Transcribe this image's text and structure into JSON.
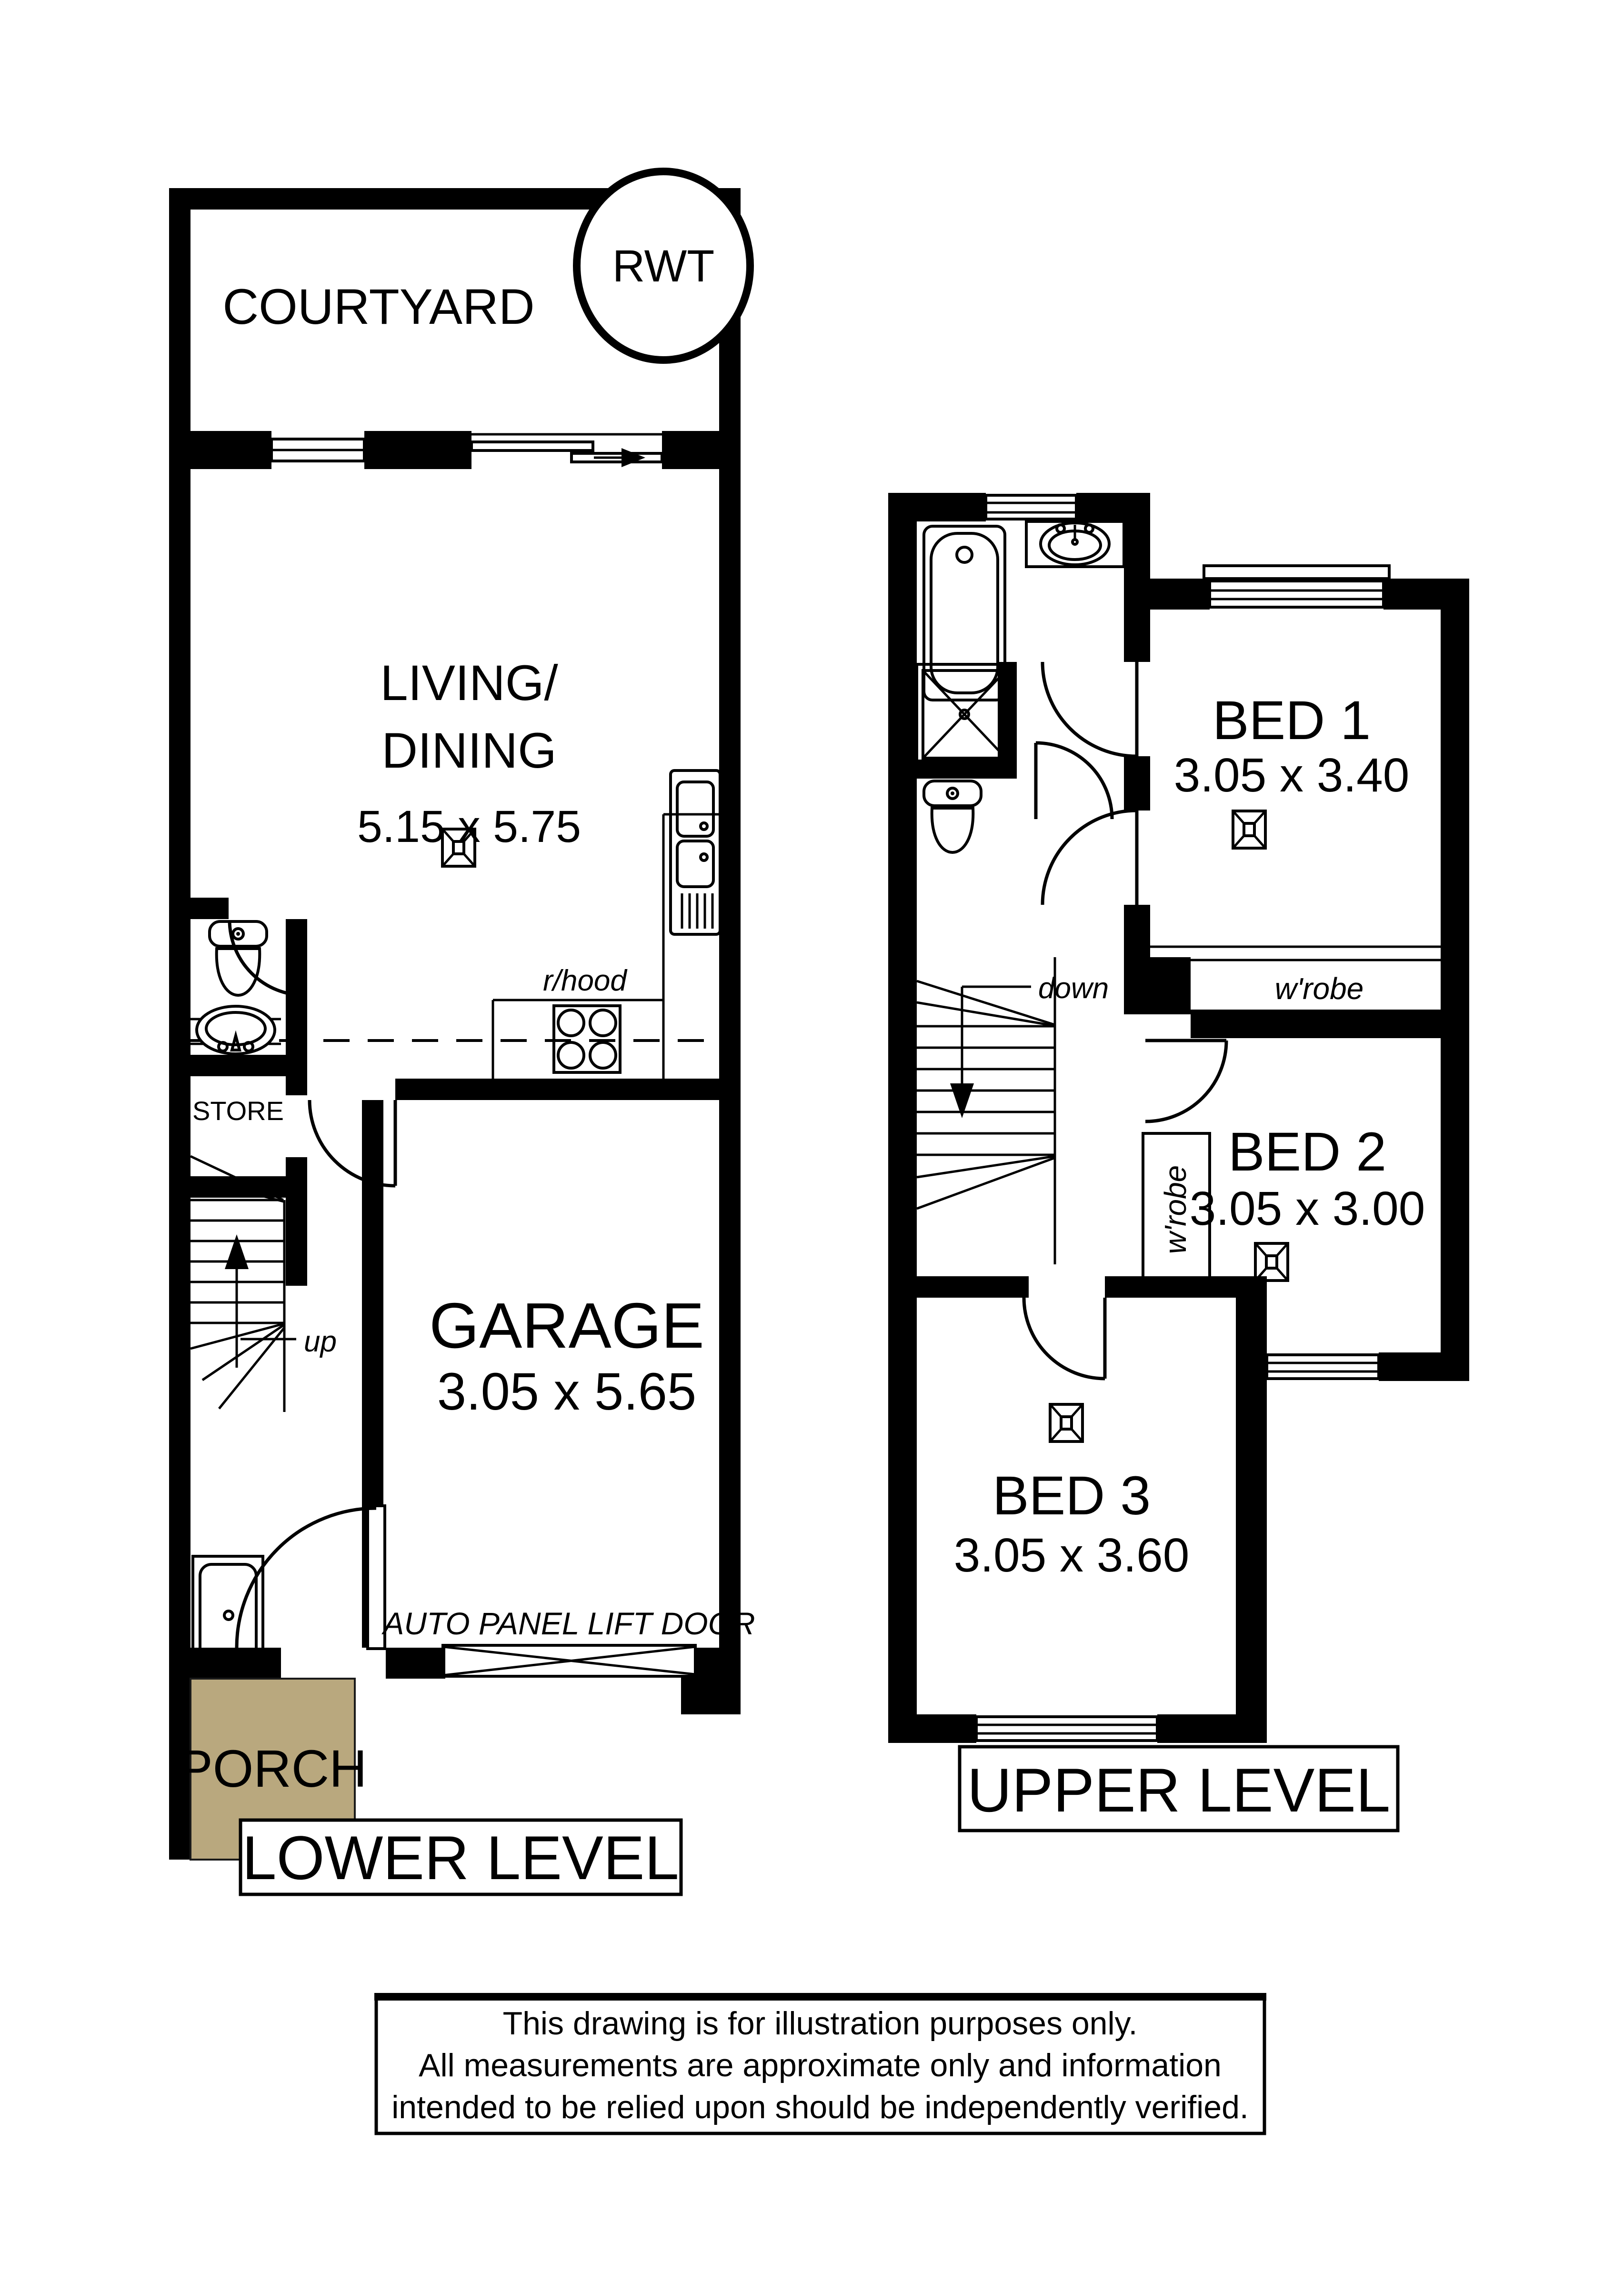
{
  "plan": {
    "courtyard_label": "COURTYARD",
    "rwt_label": "RWT",
    "living_line1": "LIVING/",
    "living_line2": "DINING",
    "living_dims": "5.15 x 5.75",
    "rhood_label": "r/hood",
    "store_label": "STORE",
    "up_label": "up",
    "down_label": "down",
    "garage_label": "GARAGE",
    "garage_dims": "3.05 x 5.65",
    "auto_door_label": "AUTO PANEL LIFT DOOR",
    "porch_label": "PORCH",
    "lower_level_label": "LOWER LEVEL",
    "upper_level_label": "UPPER LEVEL",
    "bed1_label": "BED 1",
    "bed1_dims": "3.05 x 3.40",
    "bed2_label": "BED 2",
    "bed2_dims": "3.05 x 3.00",
    "bed3_label": "BED 3",
    "bed3_dims": "3.05 x 3.60",
    "wrobe_bed1": "w'robe",
    "wrobe_bed2": "w'robe",
    "porch_color": "#b9a87e"
  },
  "disclaimer": {
    "line1": "This drawing is for illustration purposes only.",
    "line2": "All measurements are approximate only and information",
    "line3": "intended to be relied upon should be independently verified."
  }
}
